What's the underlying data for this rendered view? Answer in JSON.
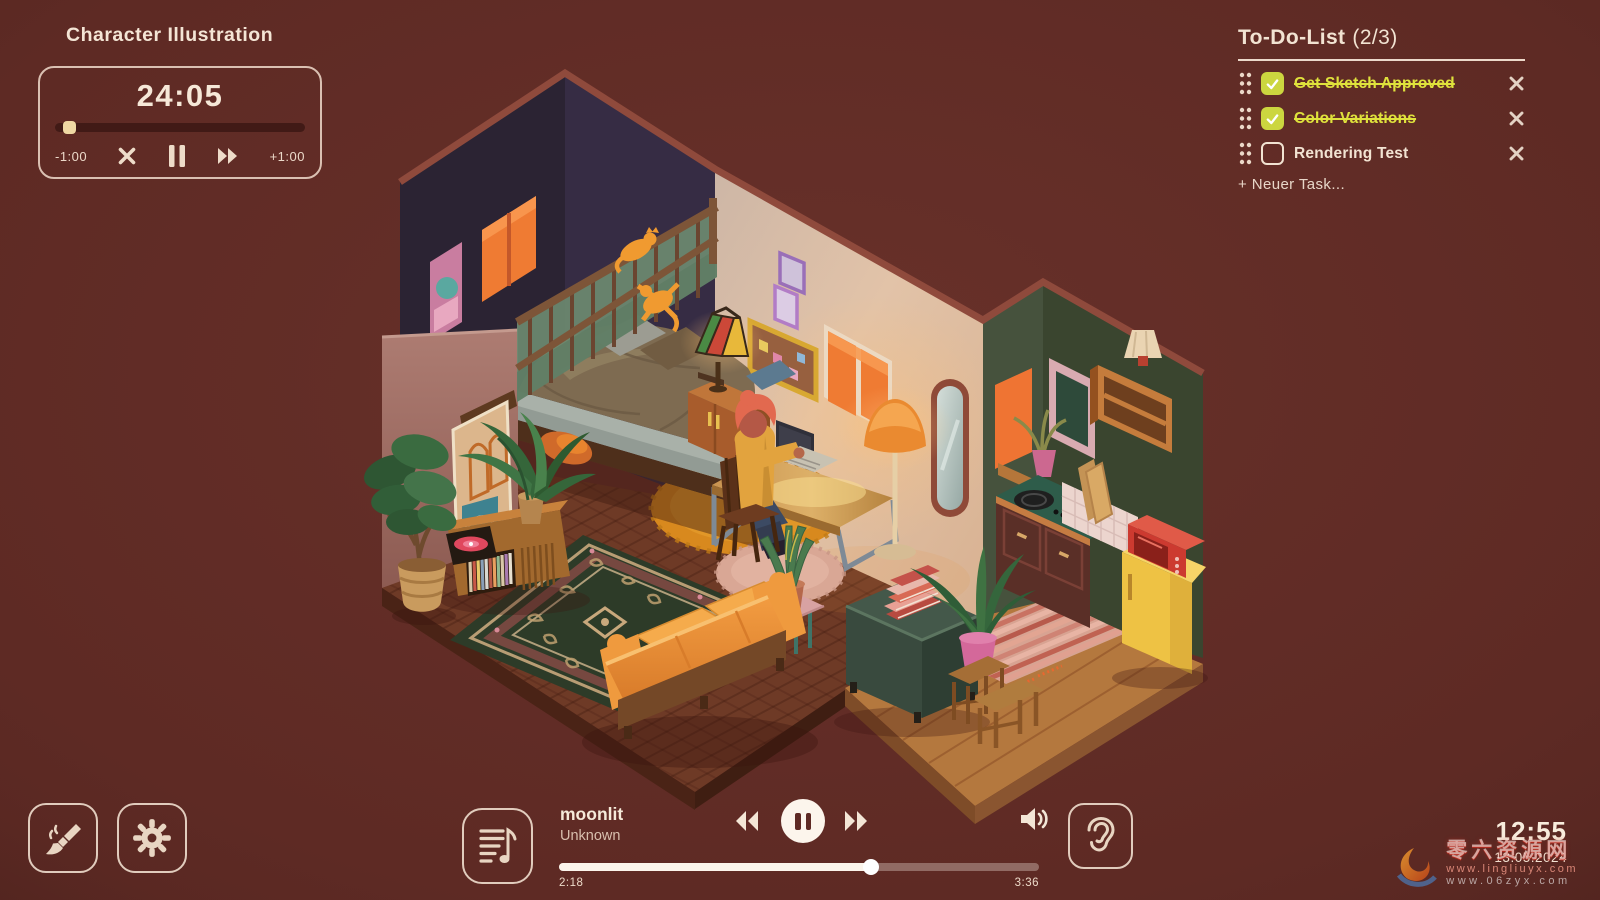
{
  "session": {
    "title": "Character Illustration",
    "time_remaining": "24:05",
    "skip_back_label": "-1:00",
    "skip_forward_label": "+1:00",
    "progress_pct": 3
  },
  "todo": {
    "title": "To-Do-List",
    "counter": "(2/3)",
    "items": [
      {
        "label": "Get Sketch Approved",
        "done": true
      },
      {
        "label": "Color Variations",
        "done": true
      },
      {
        "label": "Rendering Test",
        "done": false
      }
    ],
    "add_label": "+ Neuer Task..."
  },
  "player": {
    "title": "moonlit",
    "artist": "Unknown",
    "elapsed": "2:18",
    "duration": "3:36",
    "progress_pct": 65
  },
  "clock": {
    "time": "12:55",
    "date": "13.05.2024"
  },
  "watermark": {
    "brand": "零六资源网",
    "line1": "www.lingliuyx.com",
    "line2": "www.06zyx.com"
  },
  "colors": {
    "background": "#5e2a24",
    "cream": "#f2e3d2",
    "accent_yellow": "#ccd63f",
    "lamp_orange": "#ea8a30"
  }
}
